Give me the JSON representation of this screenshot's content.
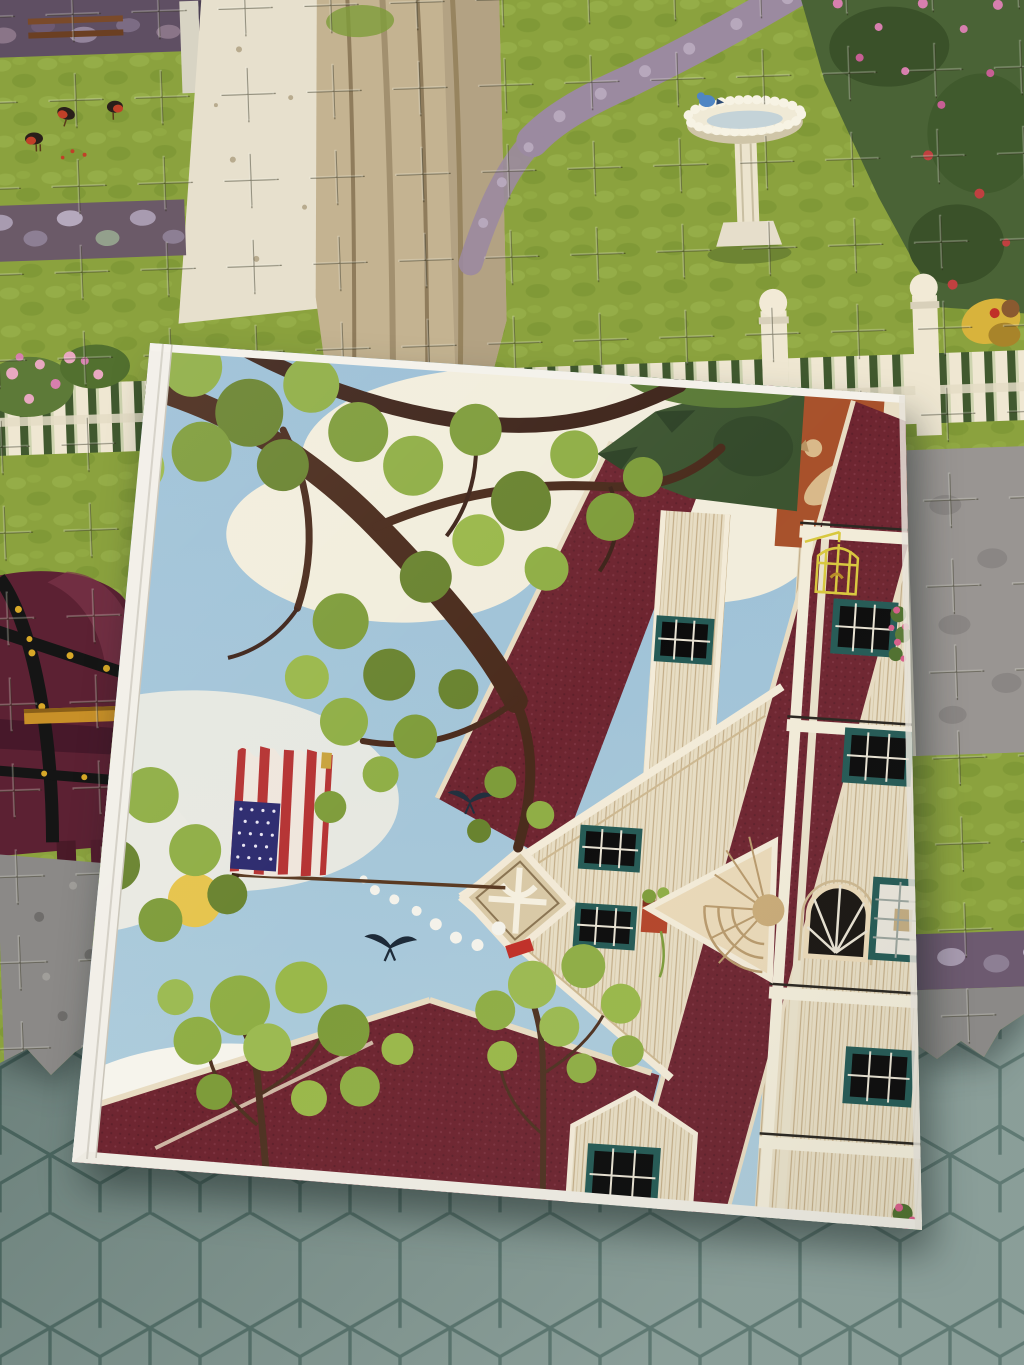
{
  "scene": {
    "description": "Top-down photo of a partially assembled folk-art jigsaw puzzle with its illustrated box lid lying on top, on a teal hexagonal-tile tabletop",
    "surface_label": "hexagon tile tabletop",
    "puzzle_label": "partially assembled jigsaw puzzle",
    "lid_label": "puzzle box lid with folk-art house painting"
  },
  "assembled_puzzle": {
    "objects": [
      "green lawn",
      "three robins on grass",
      "purple stone wall",
      "white garden gate posts",
      "pale dirt path",
      "large beige tree trunk",
      "winding cobblestone path",
      "white birdbath with bluebird",
      "dark rose hedge with pink blossoms",
      "white picket fence with ball-top posts",
      "burgundy horse with black and yellow harness",
      "gray road",
      "gardener figure in yellow"
    ]
  },
  "box_lid_art": {
    "objects": [
      "light blue sky",
      "cream clouds",
      "yellow sun",
      "oak branches with green foliage",
      "American flag hung from pole",
      "red chimney pipe with white smoke",
      "two black swallows",
      "folk-art house",
      "dark red roofs",
      "cream clapboard siding",
      "teal-framed black windows",
      "golden hayloft window",
      "sunburst pediment",
      "diamond gable ornament",
      "yellow hanging birdcage",
      "tan dachshund on brick chimney",
      "window boxes with pink roses",
      "small green trees"
    ]
  },
  "palette": {
    "tile": "#7d938d",
    "tile_grout": "#4d6a63",
    "grass": "#8ba23e",
    "stone_wall": "#6b5a68",
    "trunk": "#c4b391",
    "sky": "#9bbfd6",
    "sun": "#e6c44c",
    "roof_maroon": "#6e2530",
    "wall_cream": "#e7ddc4",
    "window_teal": "#255a55",
    "chimney_sienna": "#a8512b",
    "flag_red": "#b53232",
    "flag_blue": "#2c2a6e",
    "birdcage_yellow": "#d8c83e",
    "rose_pink": "#d77fae",
    "lid_edge_white": "#f2efe8"
  }
}
